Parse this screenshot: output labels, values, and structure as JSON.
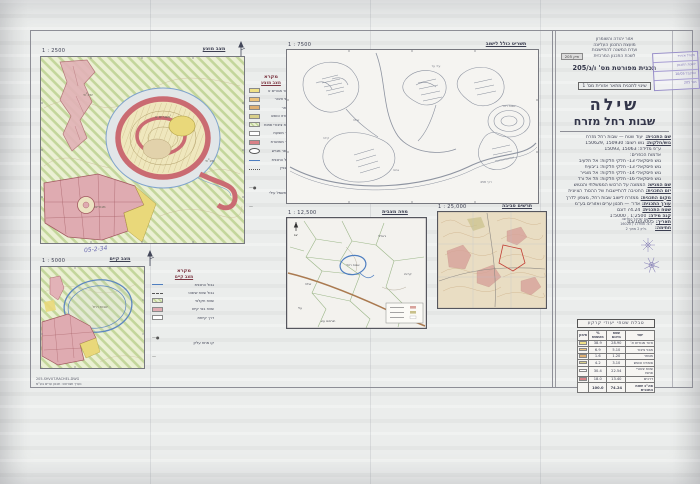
{
  "sheet": {
    "header_lines": [
      {
        "text": "אזור יהודה והשומרון"
      },
      {
        "text": "מועצת התכנון העליונה"
      },
      {
        "text": "ועדת המשנה להתיישבות"
      },
      {
        "text": "לשכת התכנון המרכזית"
      }
    ],
    "file_box": "תיק 205",
    "plan_type": "תכנית מפורטת מס' ו/ג/205",
    "amendment": "שינוי לתכנית מתאר אזורית מס' 1",
    "title_main": "שילה",
    "title_sub": "שבות רחל מזרח",
    "handwritten_note": "05-2-34",
    "footer_lines": [
      {
        "text": "205-SHVUT-RACHEL.DWG"
      },
      {
        "text": "נערך ושורטט: תכנון ערים בע\"מ"
      }
    ]
  },
  "panels": {
    "proposed": {
      "scale": "1 : 2500",
      "label": "מצב מוצע"
    },
    "overall": {
      "scale": "1 : 7500",
      "label": "תשריט כולל לישוב"
    },
    "vicinity": {
      "scale": "1 : 12,500",
      "label": "מפה מצבית"
    },
    "surroundings": {
      "scale": "1 : 25,000",
      "label": "תרשים סביבה"
    },
    "existing": {
      "scale": "1 : 5000",
      "label": "מצב קיים"
    }
  },
  "legend_proposed": {
    "title": "מקרא",
    "subtitle": "מצב מוצע",
    "items": [
      {
        "swatch": "#f0e187",
        "label": "אזור מגורים א'"
      },
      {
        "swatch": "#ecc37c",
        "label": "מבני ציבור"
      },
      {
        "swatch": "#dfb073",
        "label": "מסחר"
      },
      {
        "swatch": "#d9cf8a",
        "label": "ספורט ונופש"
      },
      {
        "swatch": "hatch",
        "label": "שטח ציבורי פתוח"
      },
      {
        "swatch": "white",
        "label": "דרך מוצעת"
      },
      {
        "swatch": "#d98086",
        "label": "דרך מאושרת"
      },
      {
        "swatch": "oval",
        "label": "מספר מגרש"
      },
      {
        "swatch": "blue-line",
        "label": "גבול התכנית"
      },
      {
        "swatch": "dotted",
        "label": "קו בניין"
      },
      {
        "swatch": "symbol",
        "label": "קו חשמל עילי"
      }
    ]
  },
  "legend_existing": {
    "title": "מקרא",
    "subtitle": "מצב קיים",
    "items": [
      {
        "swatch": "blue-line",
        "label": "גבול התכנית"
      },
      {
        "swatch": "dashed",
        "label": "גבול שטח שיפוט"
      },
      {
        "swatch": "hatch",
        "label": "שטח חקלאי"
      },
      {
        "swatch": "#e0acb2",
        "label": "שטח בנוי קיים"
      },
      {
        "swatch": "white",
        "label": "דרך קיימת"
      },
      {
        "swatch": "symbol",
        "label": "קו מתח עליון"
      }
    ]
  },
  "details": [
    {
      "label": "שם התכנית:",
      "value": "יעוד שטח — שבות רחל מזרח"
    },
    {
      "label": "גוש/חלקות:",
      "value": "גוש רשום: 150930 ,150629"
    },
    {
      "label": "",
      "value": "ע\"פ מדידה: 15063 ,15093"
    },
    {
      "label": "",
      "value": "אדמות הכפרים:"
    },
    {
      "label": "",
      "value": "גוש פיסקאלי 13- חלקי חלקות: אל תלעיב"
    },
    {
      "label": "",
      "value": "גוש פיסקאלי 13- חלקי חלקות: ג'יבעית"
    },
    {
      "label": "",
      "value": "גוש פיסקאלי 14- חלקי חלקות: אל מוגייר"
    },
    {
      "label": "",
      "value": "גוש פיסקאלי 16- חלקי חלקות: תל אל ורד"
    },
    {
      "label": "שם המגיש:",
      "value": "הממונה על הרכוש הממשלתי והנטוש"
    },
    {
      "label": "יזם התכנית:",
      "value": "החטיבה להתיישבות של ההסת' הציונית"
    },
    {
      "label": "מקום התכנית:",
      "value": "ממזרח לישוב שבות רחל, מצפון לדרך"
    },
    {
      "label": "עורך התכנית:",
      "value": "אדר' — תכנון ערים ואזורים בע\"מ"
    },
    {
      "label": "שטח התכנית:",
      "value": "74.24 דונם"
    },
    {
      "label": "קנה מידה:",
      "value": "1:2500 , 1:5000"
    },
    {
      "label": "תאריך:",
      "value": "05/10/2005"
    },
    {
      "label": "חתימה:",
      "value": ""
    }
  ],
  "coords_note": [
    {
      "text": "רשת ישראל החדשה"
    },
    {
      "text": "נ.צ. 17550 / 16020"
    },
    {
      "text": "גליון 2 מתוך 2"
    }
  ],
  "stamp": {
    "lines": [
      {
        "text": "מינהל אזרחי"
      },
      {
        "text": "לשכת התכנון"
      },
      {
        "text": "התקבל 10/05"
      },
      {
        "text": "מס' 205"
      }
    ]
  },
  "area_table": {
    "title": "טבלת שטחי יעודי קרקע",
    "headers": [
      "יעוד",
      "שטח בדונם",
      "% מהשטח",
      "סימון"
    ],
    "rows": [
      {
        "use": "אזור מגורים א'",
        "area": "28.90",
        "pct": "38.9",
        "swatch": "#f0e187"
      },
      {
        "use": "מבני ציבור",
        "area": "5.10",
        "pct": "6.9",
        "swatch": "#ecc37c"
      },
      {
        "use": "מסחר",
        "area": "1.20",
        "pct": "1.6",
        "swatch": "#dfb073"
      },
      {
        "use": "ספורט ונופש",
        "area": "3.10",
        "pct": "4.2",
        "swatch": "#d9cf8a"
      },
      {
        "use": "שטח ציבורי פתוח",
        "area": "22.54",
        "pct": "30.4",
        "swatch": "hatch"
      },
      {
        "use": "דרכים",
        "area": "13.40",
        "pct": "18.0",
        "swatch": "#d98086"
      }
    ],
    "total": {
      "use": "סה\"כ שטח התכנית",
      "area": "74.24",
      "pct": "100.0"
    }
  },
  "map_labels": {
    "shvut_rachel": "שבות רחל",
    "shilo": "שילה",
    "eli": "עלי",
    "jalud": "ג'אלוד",
    "qaryut": "קריות",
    "turmus": "תורמוס עיא",
    "adei_ad": "עדי עד",
    "kida": "קידה",
    "ahiya": "אחיה",
    "road458": "דרך 458",
    "residential_a": "מגורים א'",
    "residential": "מגורים",
    "public_open": "שצ\"פ",
    "north": "צפ'"
  }
}
